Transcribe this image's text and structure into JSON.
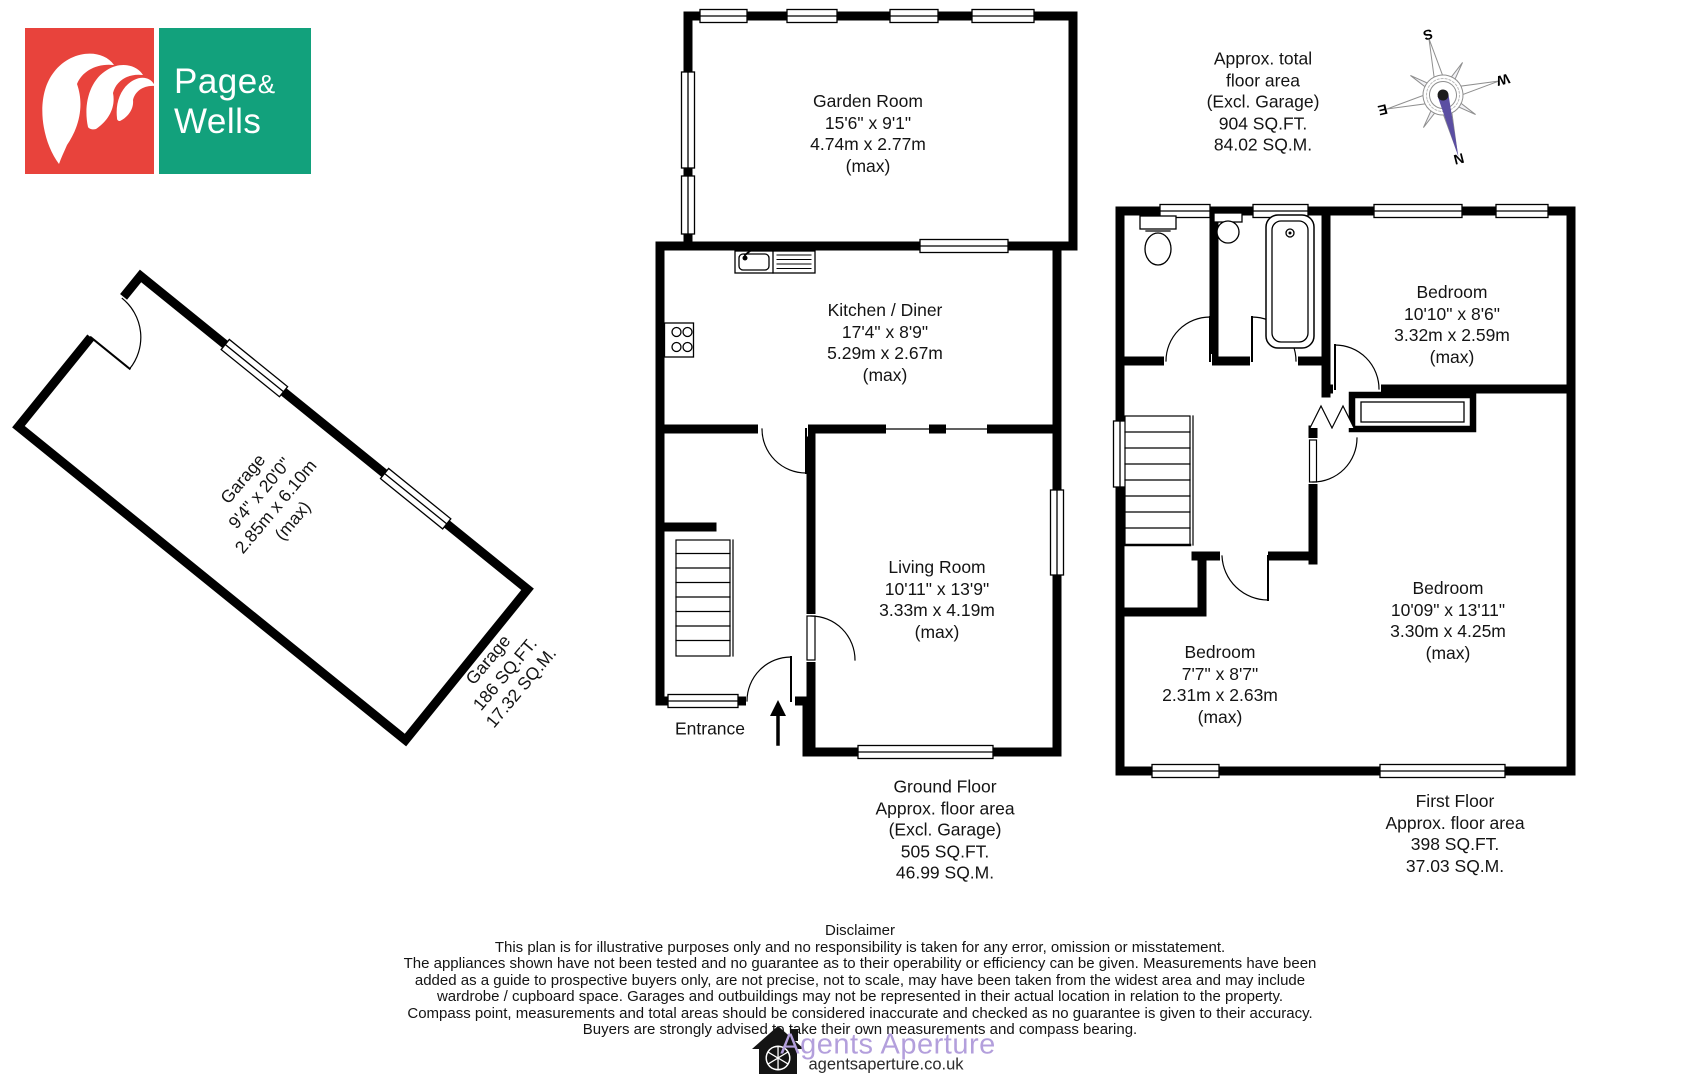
{
  "logo": {
    "word1": "Page",
    "amp": "&",
    "word2": "Wells"
  },
  "total_area": {
    "l1": "Approx. total",
    "l2": "floor area",
    "l3": "(Excl. Garage)",
    "l4": "904 SQ.FT.",
    "l5": "84.02 SQ.M."
  },
  "compass": {
    "n": "N",
    "s": "S",
    "e": "E",
    "w": "W"
  },
  "garage": {
    "name": "Garage",
    "imperial": "9'4\" x 20'0\"",
    "metric": "2.85m x 6.10m",
    "max": "(max)",
    "label_name": "Garage",
    "label_sqft": "186 SQ.FT.",
    "label_sqm": "17.32 SQ.M."
  },
  "ground_floor": {
    "garden_room": {
      "name": "Garden Room",
      "imperial": "15'6\" x 9'1\"",
      "metric": "4.74m x 2.77m",
      "max": "(max)"
    },
    "kitchen": {
      "name": "Kitchen / Diner",
      "imperial": "17'4\" x 8'9\"",
      "metric": "5.29m x 2.67m",
      "max": "(max)"
    },
    "living_room": {
      "name": "Living Room",
      "imperial": "10'11\" x 13'9\"",
      "metric": "3.33m x 4.19m",
      "max": "(max)"
    },
    "entrance": "Entrance",
    "label": {
      "l1": "Ground Floor",
      "l2": "Approx. floor area",
      "l3": "(Excl. Garage)",
      "l4": "505 SQ.FT.",
      "l5": "46.99 SQ.M."
    }
  },
  "first_floor": {
    "bedroom1": {
      "name": "Bedroom",
      "imperial": "10'10\" x 8'6\"",
      "metric": "3.32m x 2.59m",
      "max": "(max)"
    },
    "bedroom2": {
      "name": "Bedroom",
      "imperial": "10'09\" x 13'11\"",
      "metric": "3.30m x 4.25m",
      "max": "(max)"
    },
    "bedroom3": {
      "name": "Bedroom",
      "imperial": "7'7\" x 8'7\"",
      "metric": "2.31m x 2.63m",
      "max": "(max)"
    },
    "label": {
      "l1": "First Floor",
      "l2": "Approx. floor area",
      "l3": "398 SQ.FT.",
      "l4": "37.03 SQ.M."
    }
  },
  "disclaimer": {
    "title": "Disclaimer",
    "lines": [
      "This plan is for illustrative purposes only and no responsibility is taken for any error, omission or misstatement.",
      "The appliances shown have not been tested and no guarantee as to their operability or efficiency can be given. Measurements have been",
      "added as a guide to prospective buyers only, are not precise, not to scale, may have been taken from the widest area and may include",
      "wardrobe / cupboard space. Garages and outbuildings may not be represented in their actual location in relation to  the property.",
      "Compass point, measurements and total areas should be considered inaccurate and checked as no guarantee is given to their accuracy.",
      "Buyers are strongly advised to take their own measurements and compass bearing."
    ]
  },
  "footer": {
    "brand": "Agents Aperture",
    "url": "agentsaperture.co.uk"
  },
  "colors": {
    "logo_red": "#e8433c",
    "logo_green": "#12a17c",
    "brand_purple": "#b39fdc",
    "needle_purple": "#5b4ea2"
  }
}
